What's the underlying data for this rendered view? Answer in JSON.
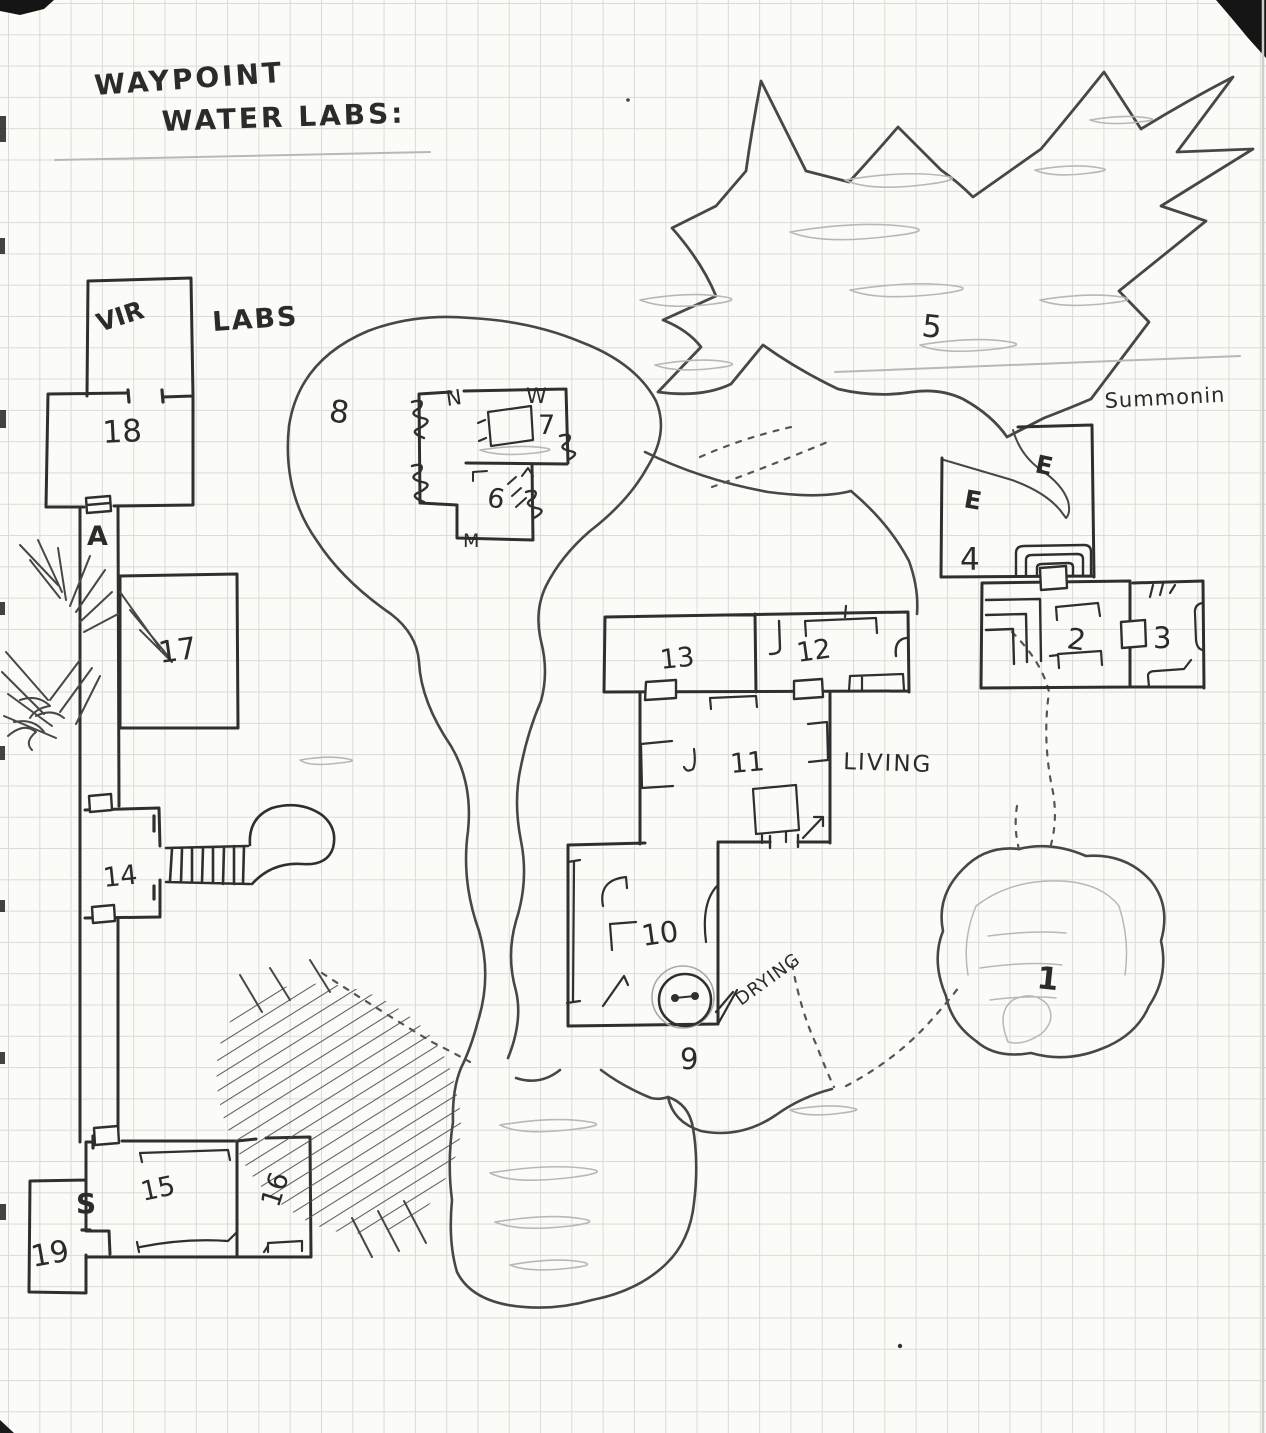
{
  "title": {
    "line1": "WAYPOINT",
    "line2": "WATER LABS:"
  },
  "labels": {
    "vir": "VIR",
    "labs": "LABS",
    "room18": "18",
    "door_a": "A",
    "room17": "17",
    "room14": "14",
    "room15": "15",
    "room16": "16",
    "room19": "19",
    "door_s": "S",
    "room8": "8",
    "room7": "7",
    "room6": "6",
    "mark_n": "N",
    "mark_w": "W",
    "mark_m": "M",
    "room5": "5",
    "summoning": "Summonin",
    "elemental_1": "E",
    "elemental_2": "E",
    "room4": "4",
    "room2": "2",
    "room3": "3",
    "room13": "13",
    "room12": "12",
    "room11": "11",
    "living": "LIVING",
    "room10": "10",
    "drying": "DRYING",
    "room9": "9",
    "room1": "1"
  },
  "colors": {
    "paper": "#fbfbf8",
    "grid": "#d9dcd6",
    "ink": "#2f2f2f",
    "cave_ink": "#474747",
    "pencil": "#b8b8b8",
    "trail": "#5a5a5a"
  }
}
